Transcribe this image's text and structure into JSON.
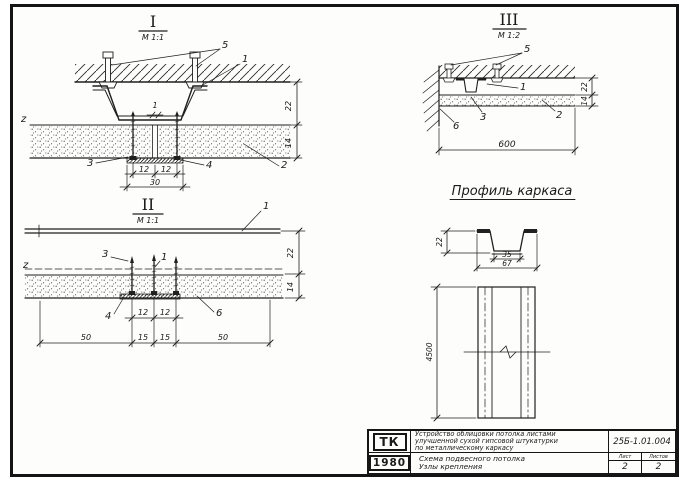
{
  "drawing": {
    "s1": {
      "numeral": "I",
      "scale": "М 1:1",
      "callouts": {
        "c1": "1",
        "c2": "2",
        "c3": "3",
        "c4": "4",
        "c5": "5",
        "z": "z",
        "gap": "1"
      },
      "dims": {
        "d12a": "12",
        "d12b": "12",
        "d30": "30",
        "dv22": "22",
        "dv14": "14"
      }
    },
    "s2": {
      "numeral": "II",
      "scale": "М 1:1",
      "callouts": {
        "c1": "1",
        "c1b": "1",
        "c3": "3",
        "c4": "4",
        "c6": "6",
        "z": "z"
      },
      "dims": {
        "d12a": "12",
        "d12b": "12",
        "d50a": "50",
        "d15a": "15",
        "d15b": "15",
        "d50b": "50",
        "dv22": "22",
        "dv14": "14"
      }
    },
    "s3": {
      "numeral": "III",
      "scale": "М 1:2",
      "callouts": {
        "c1": "1",
        "c2": "2",
        "c3": "3",
        "c5": "5",
        "c6": "6"
      },
      "dims": {
        "d600": "600",
        "dv22": "22",
        "dv14": "14"
      }
    },
    "profile": {
      "title": "Профиль каркаса",
      "dims": {
        "h": "22",
        "w_inner": "35",
        "w_outer": "67",
        "length": "4500"
      }
    }
  },
  "title_block": {
    "org": "ТК",
    "year": "1980",
    "title_lines": [
      "Устройство облицовки потолка листами",
      "улучшенной сухой гипсовой штукатурки",
      "по металлическому каркасу"
    ],
    "subtitle_lines": [
      "Схема подвесного потолка",
      "Узлы крепления"
    ],
    "doc_number": "25Б-1.01.004",
    "sheet_label": "Лист",
    "sheet_value": "2",
    "sheets_label": "Листов",
    "sheets_value": "2"
  }
}
